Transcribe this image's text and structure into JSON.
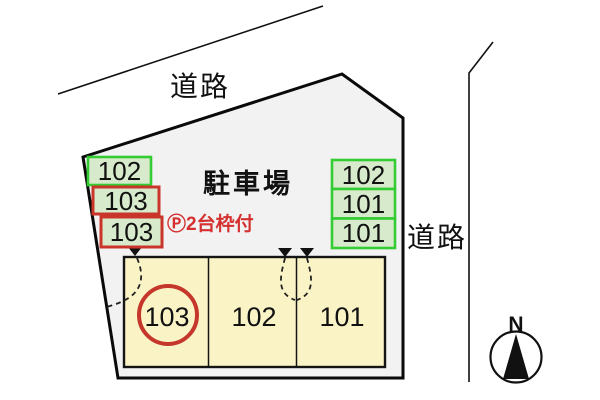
{
  "roads": {
    "top_label": "道路",
    "right_label": "道路"
  },
  "parking_area": {
    "label": "駐車場"
  },
  "note": {
    "label": "Ⓟ2台枠付"
  },
  "left_stack": {
    "items": [
      {
        "label": "102",
        "border": "green"
      },
      {
        "label": "103",
        "border": "red"
      },
      {
        "label": "103",
        "border": "red"
      }
    ]
  },
  "right_stack": {
    "items": [
      {
        "label": "102",
        "border": "green"
      },
      {
        "label": "101",
        "border": "green"
      },
      {
        "label": "101",
        "border": "green"
      }
    ]
  },
  "building": {
    "units": [
      {
        "label": "103",
        "circled": true
      },
      {
        "label": "102",
        "circled": false
      },
      {
        "label": "101",
        "circled": false
      }
    ]
  },
  "compass": {
    "label": "N"
  },
  "colors": {
    "line": "#111111",
    "site_fill": "#f2f2f2",
    "building_fill": "#faf3c6",
    "stall_fill": "#d7ebcc",
    "green_border": "#33cc33",
    "red_border": "#c9352b",
    "red_text": "#d3302f"
  }
}
